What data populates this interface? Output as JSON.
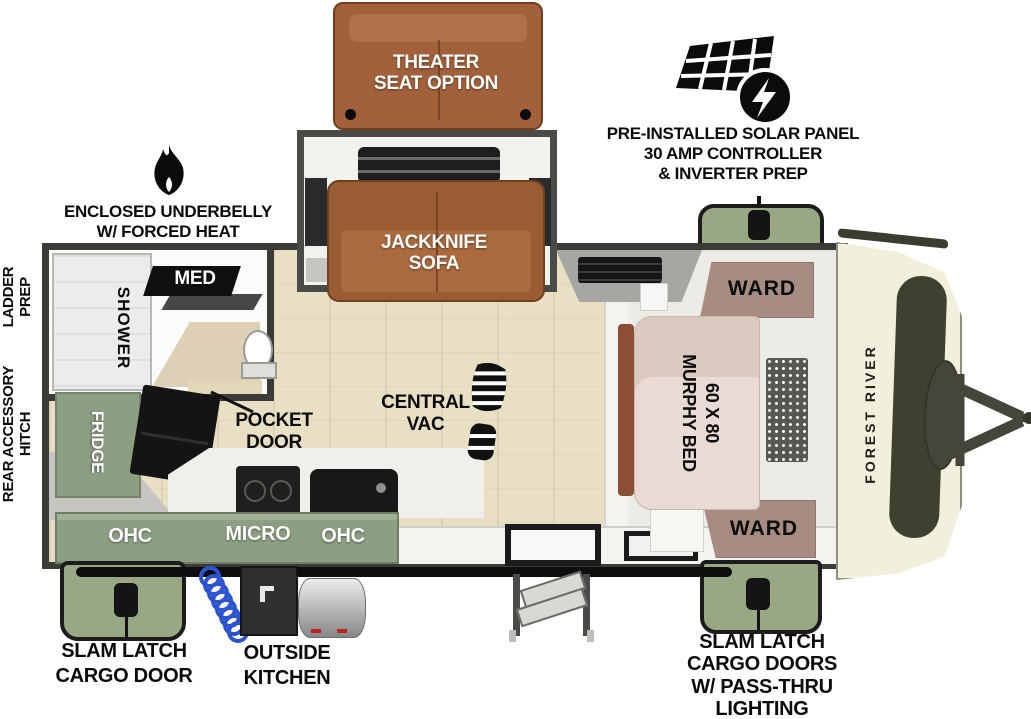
{
  "brand": {
    "logo_text": "FOREST RIVER"
  },
  "callouts": {
    "theater_seat": {
      "lines": [
        "THEATER",
        "SEAT OPTION"
      ]
    },
    "solar": {
      "icon": "solar-panel-icon",
      "lines": [
        "PRE-INSTALLED SOLAR PANEL",
        "30 AMP CONTROLLER",
        "& INVERTER PREP"
      ]
    },
    "underbelly": {
      "icon": "flame-icon",
      "lines": [
        "ENCLOSED UNDERBELLY",
        "W/ FORCED HEAT"
      ]
    },
    "ladder_prep": {
      "lines": [
        "LADDER",
        "PREP"
      ]
    },
    "rear_accessory_hitch": {
      "lines": [
        "REAR ACCESSORY",
        "HITCH"
      ]
    },
    "slam_latch_left": {
      "lines": [
        "SLAM LATCH",
        "CARGO DOOR"
      ]
    },
    "outside_kitchen": {
      "lines": [
        "OUTSIDE",
        "KITCHEN"
      ]
    },
    "slam_latch_right": {
      "lines": [
        "SLAM LATCH",
        "CARGO DOORS",
        "W/ PASS-THRU",
        "LIGHTING"
      ]
    }
  },
  "rooms": {
    "bathroom": {
      "shower": "SHOWER",
      "med_cabinet": "MED"
    },
    "living": {
      "sofa": {
        "lines": [
          "JACKKNIFE",
          "SOFA"
        ]
      },
      "central_vac": {
        "icon": "boot-print-icon",
        "lines": [
          "CENTRAL",
          "VAC"
        ]
      },
      "pocket_door": {
        "lines": [
          "POCKET",
          "DOOR"
        ]
      }
    },
    "kitchen": {
      "fridge": "FRIDGE",
      "ohc_left": "OHC",
      "micro": "MICRO",
      "ohc_right": "OHC"
    },
    "bedroom": {
      "ward_top": "WARD",
      "ward_bottom": "WARD",
      "murphy_bed": {
        "lines": [
          "60 X 80",
          "MURPHY BED"
        ]
      }
    }
  },
  "colors": {
    "cabinet_green": "#8d9f83",
    "cargo_door_green": "#99a884",
    "sofa_brown": "#9a5c33",
    "ward_mauve": "#a78d81",
    "floor_wood": "#e8dfc4",
    "front_cap_cream": "#f2efdd",
    "decal_olive": "#3e4030",
    "wall_dark": "#3b3b38",
    "hose_blue": "#2d54cf"
  }
}
